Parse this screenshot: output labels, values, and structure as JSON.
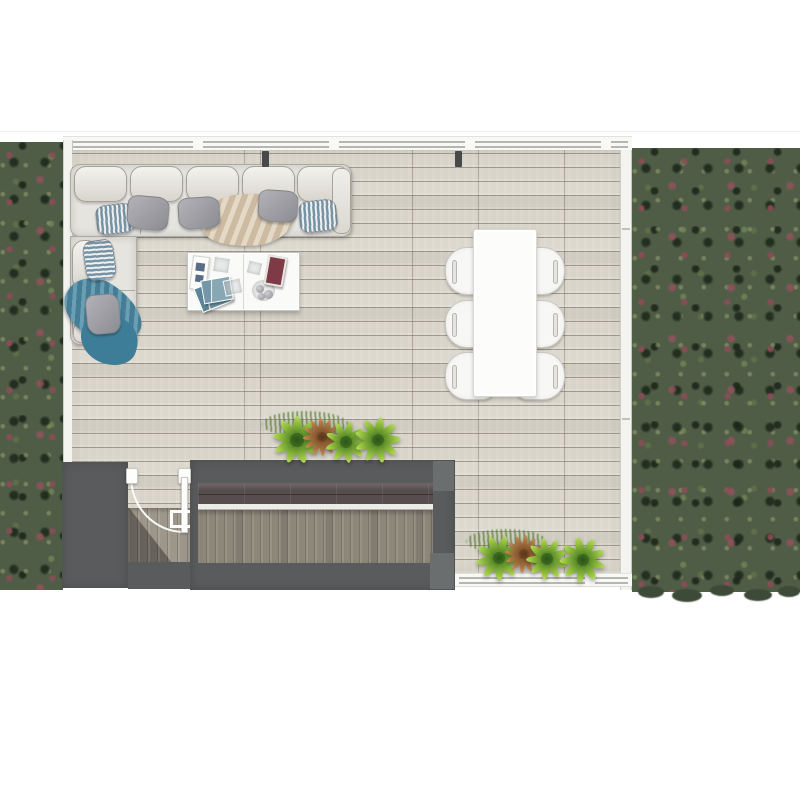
{
  "scene": {
    "type": "3d-floor-plan-top-view",
    "description": "Top view 3D rendering of an open-plan living and dining room with light wood plank flooring, an L-shaped cream sectional sofa with pillows and throws, a two-module white coffee table with magazines, a white six-seat dining table, rows of potted palms, a dark stair and bar-counter block with an open door, frameless glass walls, and lawn strips with red wildflowers on both sides."
  },
  "palette": {
    "background": "#ffffff",
    "grass_base": "#4f5d47",
    "grass_dark": "#3c4a37",
    "flower_red": "#8e4b56",
    "floor_base": "#d8d4c9",
    "floor_seam": "#746e60",
    "wall_dark": "#595b5c",
    "post_dark": "#47494b",
    "counter_wood": "#574c4e",
    "deck_wood": "#8d8679",
    "glass_white": "#f3f3f0",
    "sofa_fabric": "#e6e4df",
    "pillow_gray": "#9c9ca1",
    "pillow_stripe": "#7793a3",
    "blanket_beige": "#dacab2",
    "blanket_teal": "#4e8ba4",
    "table_white": "#fcfcfb",
    "magazine_teal": "#6b90a2",
    "magazine_maroon": "#7e3b47",
    "plant_green": "#8fbe3c",
    "plant_brown": "#a9733f"
  },
  "furniture": {
    "sofa": {
      "label": "L-shaped sectional sofa",
      "back_cushions": [
        {
          "x": 74,
          "y": 166,
          "w": 53,
          "h": 36,
          "rot": 0
        },
        {
          "x": 130,
          "y": 166,
          "w": 53,
          "h": 36,
          "rot": 0
        },
        {
          "x": 186,
          "y": 166,
          "w": 53,
          "h": 36,
          "rot": 0
        },
        {
          "x": 242,
          "y": 166,
          "w": 53,
          "h": 36,
          "rot": 0
        },
        {
          "x": 297,
          "y": 166,
          "w": 53,
          "h": 36,
          "rot": 0
        },
        {
          "x": 72,
          "y": 240,
          "w": 27,
          "h": 50,
          "rot": 0
        },
        {
          "x": 72,
          "y": 292,
          "w": 27,
          "h": 50,
          "rot": 0
        }
      ],
      "seams": [
        {
          "x": 140,
          "y": 200,
          "w": 1,
          "h": 34
        },
        {
          "x": 210,
          "y": 200,
          "w": 1,
          "h": 34
        },
        {
          "x": 280,
          "y": 200,
          "w": 1,
          "h": 34
        },
        {
          "x": 100,
          "y": 290,
          "w": 35,
          "h": 1
        }
      ],
      "arms": [
        {
          "x": 332,
          "y": 168,
          "w": 19,
          "h": 66
        },
        {
          "x": 73,
          "y": 322,
          "w": 62,
          "h": 21
        }
      ],
      "pillows": [
        {
          "x": 96,
          "y": 204,
          "w": 38,
          "h": 30,
          "rot": -7,
          "variant": "stripe"
        },
        {
          "x": 127,
          "y": 196,
          "w": 42,
          "h": 34,
          "rot": 5,
          "variant": "gray"
        },
        {
          "x": 178,
          "y": 197,
          "w": 42,
          "h": 32,
          "rot": -4,
          "variant": "gray"
        },
        {
          "x": 258,
          "y": 190,
          "w": 40,
          "h": 32,
          "rot": 4,
          "variant": "gray"
        },
        {
          "x": 299,
          "y": 200,
          "w": 38,
          "h": 32,
          "rot": -6,
          "variant": "stripe"
        },
        {
          "x": 84,
          "y": 240,
          "w": 31,
          "h": 40,
          "rot": -8,
          "variant": "stripe-h"
        },
        {
          "x": 86,
          "y": 294,
          "w": 34,
          "h": 40,
          "rot": -5,
          "variant": "gray"
        }
      ],
      "throws": [
        {
          "color_name": "beige",
          "position": "center of long section"
        },
        {
          "color_name": "teal",
          "position": "corner return section"
        }
      ]
    },
    "coffee_table": {
      "label": "two-module white coffee table",
      "items": [
        "open white book",
        "stack of teal magazines",
        "maroon magazine",
        "glass coasters",
        "bowl of decorative balls"
      ]
    },
    "dining": {
      "table_label": "white rectangular dining table",
      "chair_label": "white dining chair",
      "chair_count": 6,
      "chairs": [
        {
          "x": 445,
          "y": 247,
          "side": "left"
        },
        {
          "x": 445,
          "y": 300,
          "side": "left"
        },
        {
          "x": 445,
          "y": 352,
          "side": "left"
        },
        {
          "x": 515,
          "y": 247,
          "side": "right"
        },
        {
          "x": 515,
          "y": 300,
          "side": "right"
        },
        {
          "x": 515,
          "y": 352,
          "side": "right"
        }
      ]
    },
    "door": {
      "label": "open hinged door with swing arc",
      "state": "open"
    },
    "counter_block": {
      "label": "bar counter block with wood deck and stair opening"
    },
    "stairs": {
      "label": "staircase to lower level"
    }
  },
  "plants": {
    "count": 8,
    "items": [
      {
        "x": 297,
        "y": 440,
        "r": 24,
        "variant": "green"
      },
      {
        "x": 322,
        "y": 437,
        "r": 19,
        "variant": "brown"
      },
      {
        "x": 346,
        "y": 442,
        "r": 21,
        "variant": "green"
      },
      {
        "x": 378,
        "y": 440,
        "r": 23,
        "variant": "green"
      },
      {
        "x": 499,
        "y": 558,
        "r": 23,
        "variant": "green"
      },
      {
        "x": 524,
        "y": 554,
        "r": 19,
        "variant": "brown"
      },
      {
        "x": 547,
        "y": 559,
        "r": 21,
        "variant": "green"
      },
      {
        "x": 583,
        "y": 560,
        "r": 23,
        "variant": "green"
      }
    ],
    "tufts": [
      {
        "x": 305,
        "y": 424,
        "w": 86,
        "h": 26
      },
      {
        "x": 506,
        "y": 541,
        "w": 80,
        "h": 24
      }
    ]
  },
  "structure": {
    "posts": [
      {
        "x": 262,
        "y": 151
      },
      {
        "x": 455,
        "y": 151
      }
    ],
    "wall_joints_right": [
      78,
      268
    ],
    "lawn_edge_tufts": [
      {
        "x": 638,
        "y": 586,
        "w": 26,
        "h": 12
      },
      {
        "x": 672,
        "y": 589,
        "w": 30,
        "h": 13
      },
      {
        "x": 710,
        "y": 585,
        "w": 24,
        "h": 11
      },
      {
        "x": 744,
        "y": 589,
        "w": 28,
        "h": 12
      },
      {
        "x": 778,
        "y": 586,
        "w": 22,
        "h": 11
      }
    ],
    "decor_balls": [
      {
        "x": 4,
        "y": 5,
        "d": 8
      },
      {
        "x": 12,
        "y": 10,
        "d": 9
      },
      {
        "x": 6,
        "y": 13,
        "d": 7
      }
    ],
    "book_flecks": [
      {
        "x": 3,
        "y": 6,
        "w": 9,
        "h": 8
      },
      {
        "x": 4,
        "y": 18,
        "w": 8,
        "h": 7
      }
    ]
  }
}
